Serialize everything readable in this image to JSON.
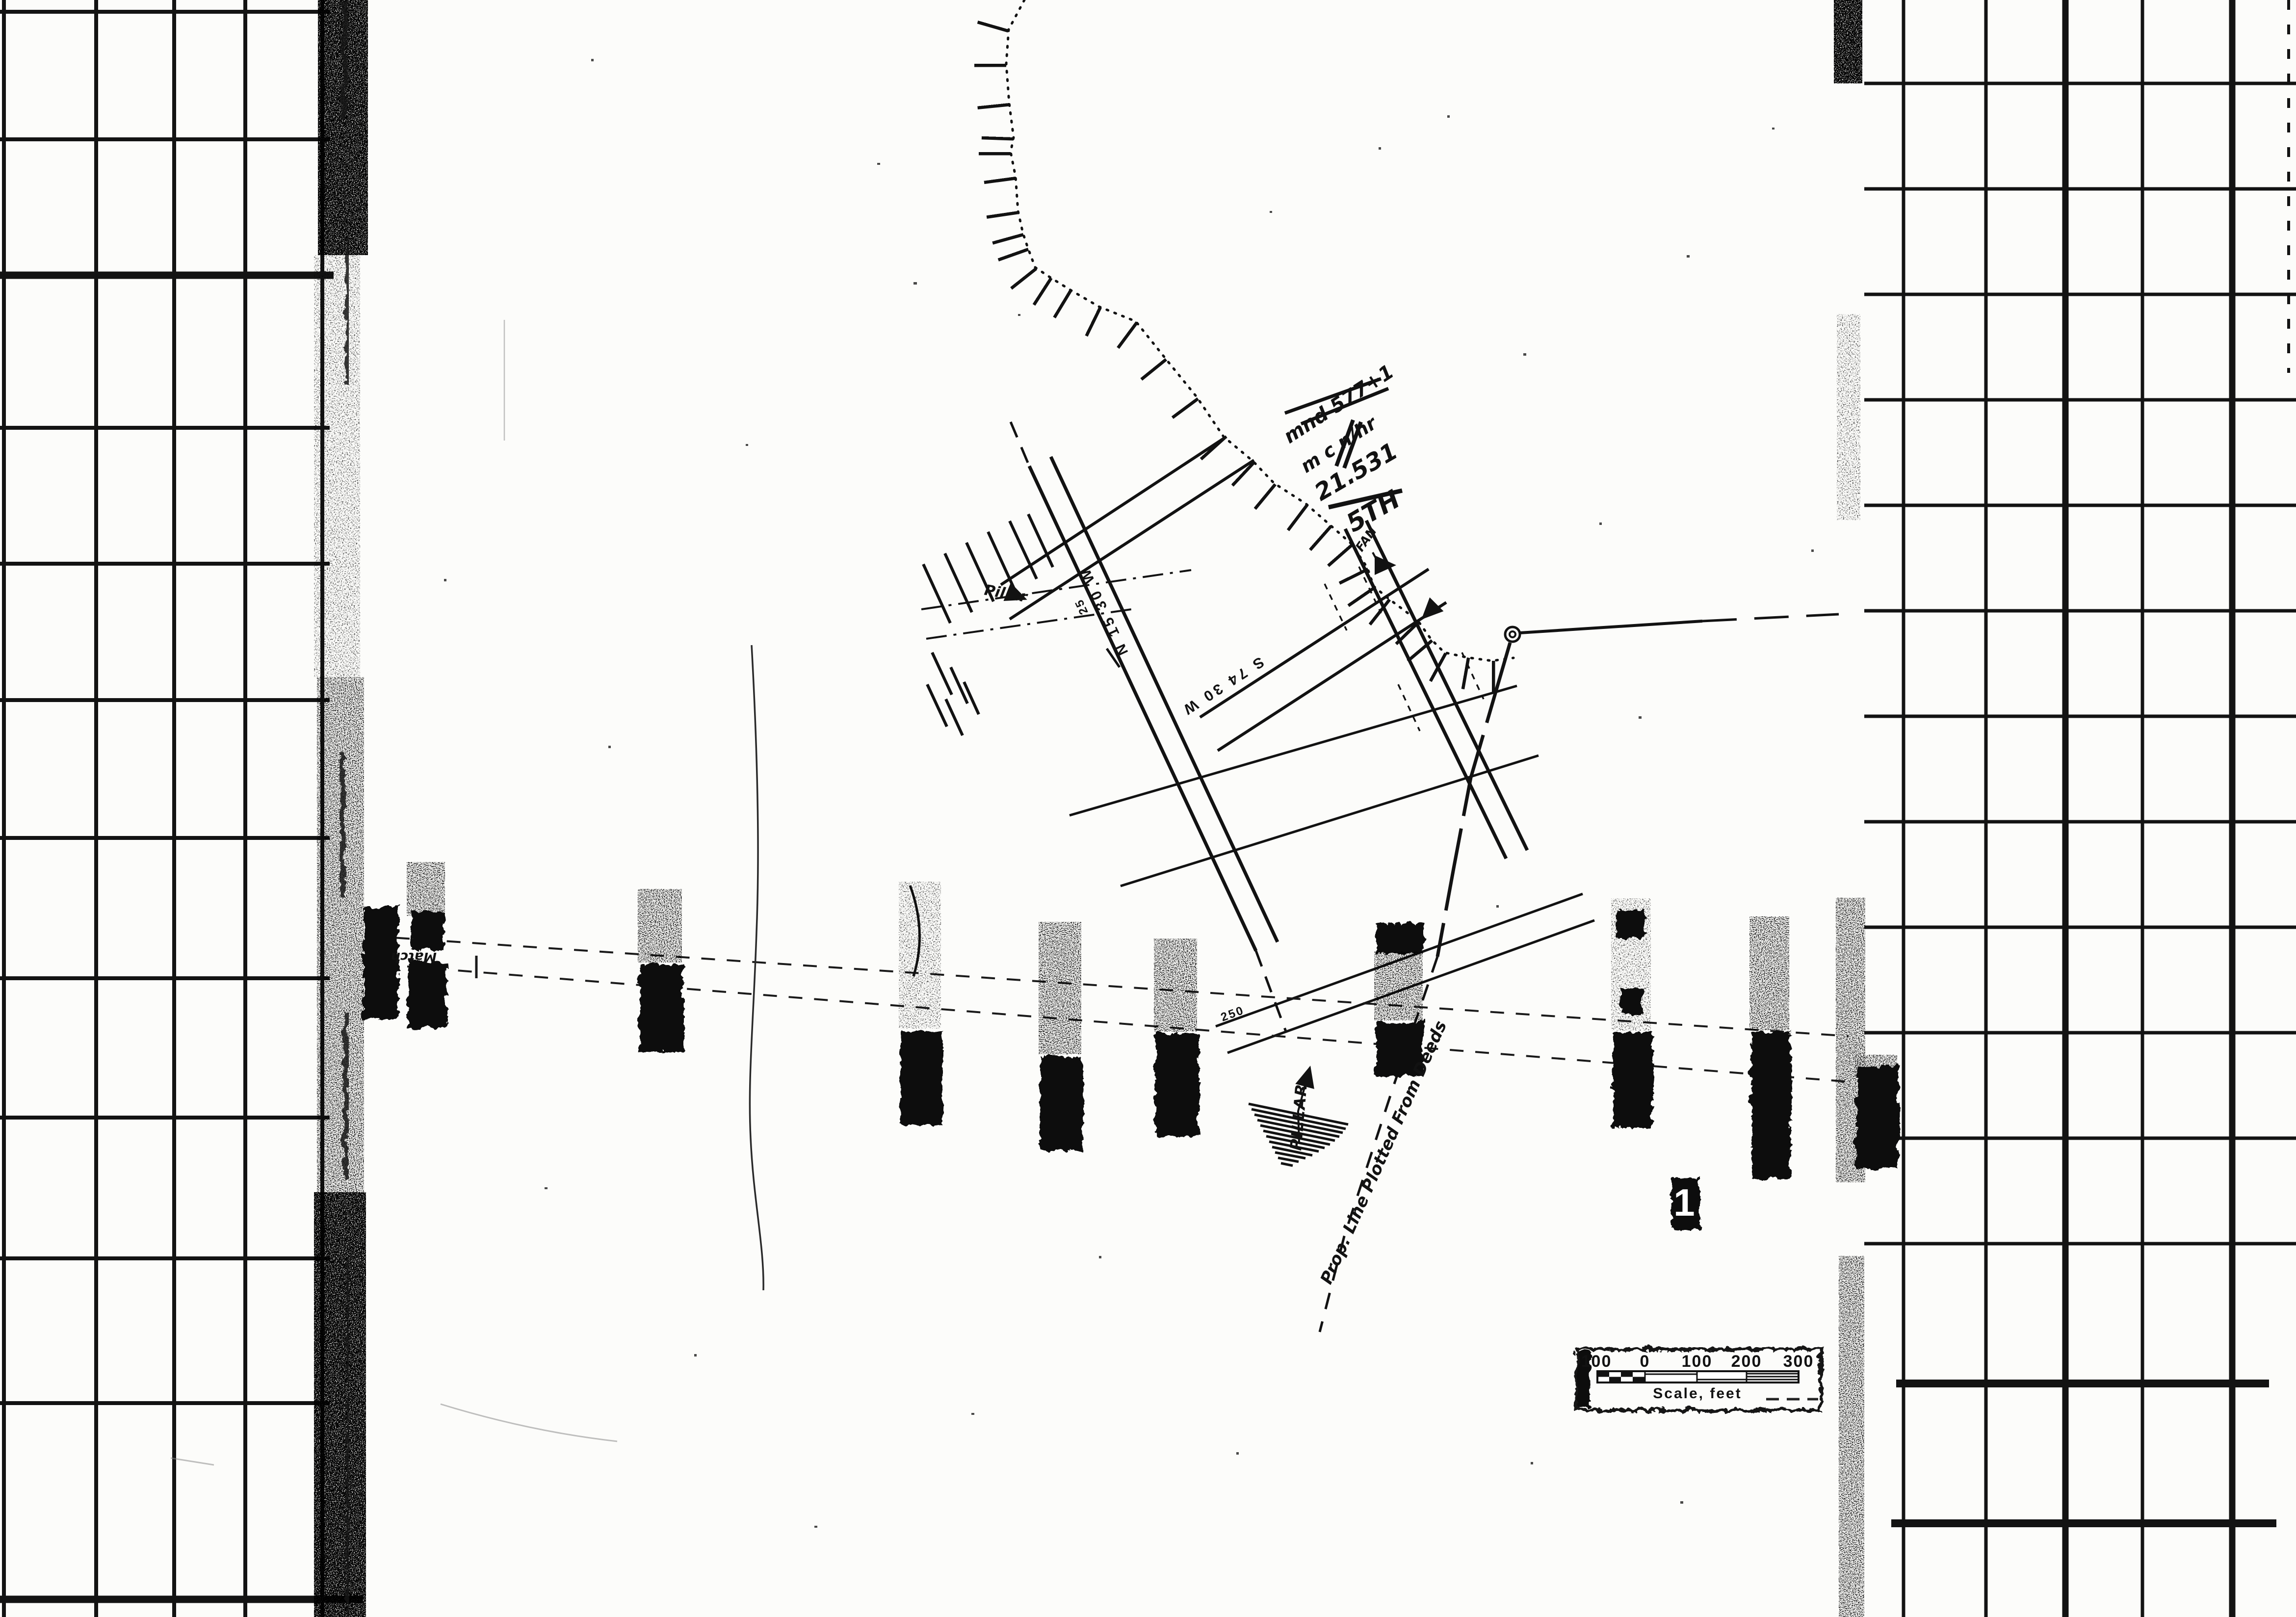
{
  "page": {
    "title": "Scanned waterfront survey map sheet on grid paper",
    "paper_color": "#fcfcfa",
    "ink_color": "#121212"
  },
  "scale_bar": {
    "labels": [
      "100",
      "0",
      "100",
      "200",
      "300"
    ],
    "caption": "Scale, feet"
  },
  "figure_marker": {
    "number": "1"
  },
  "bearings": {
    "main_street": "N 15 30 W",
    "cross_street": "S 74 30 W"
  },
  "stations": {
    "a": "25",
    "b": "250"
  },
  "labels": {
    "prop_line": "Prop. Line Plotted From Deeds",
    "pillar_hand": "Pillar",
    "pillar_print": "PILLAR",
    "match": "Match",
    "fan": "FAN"
  },
  "handwriting": {
    "line1": "mnd 577+1",
    "line2": "m c n/hr",
    "fraction_numerator": "21.531",
    "fraction_denominator": "5TH"
  }
}
